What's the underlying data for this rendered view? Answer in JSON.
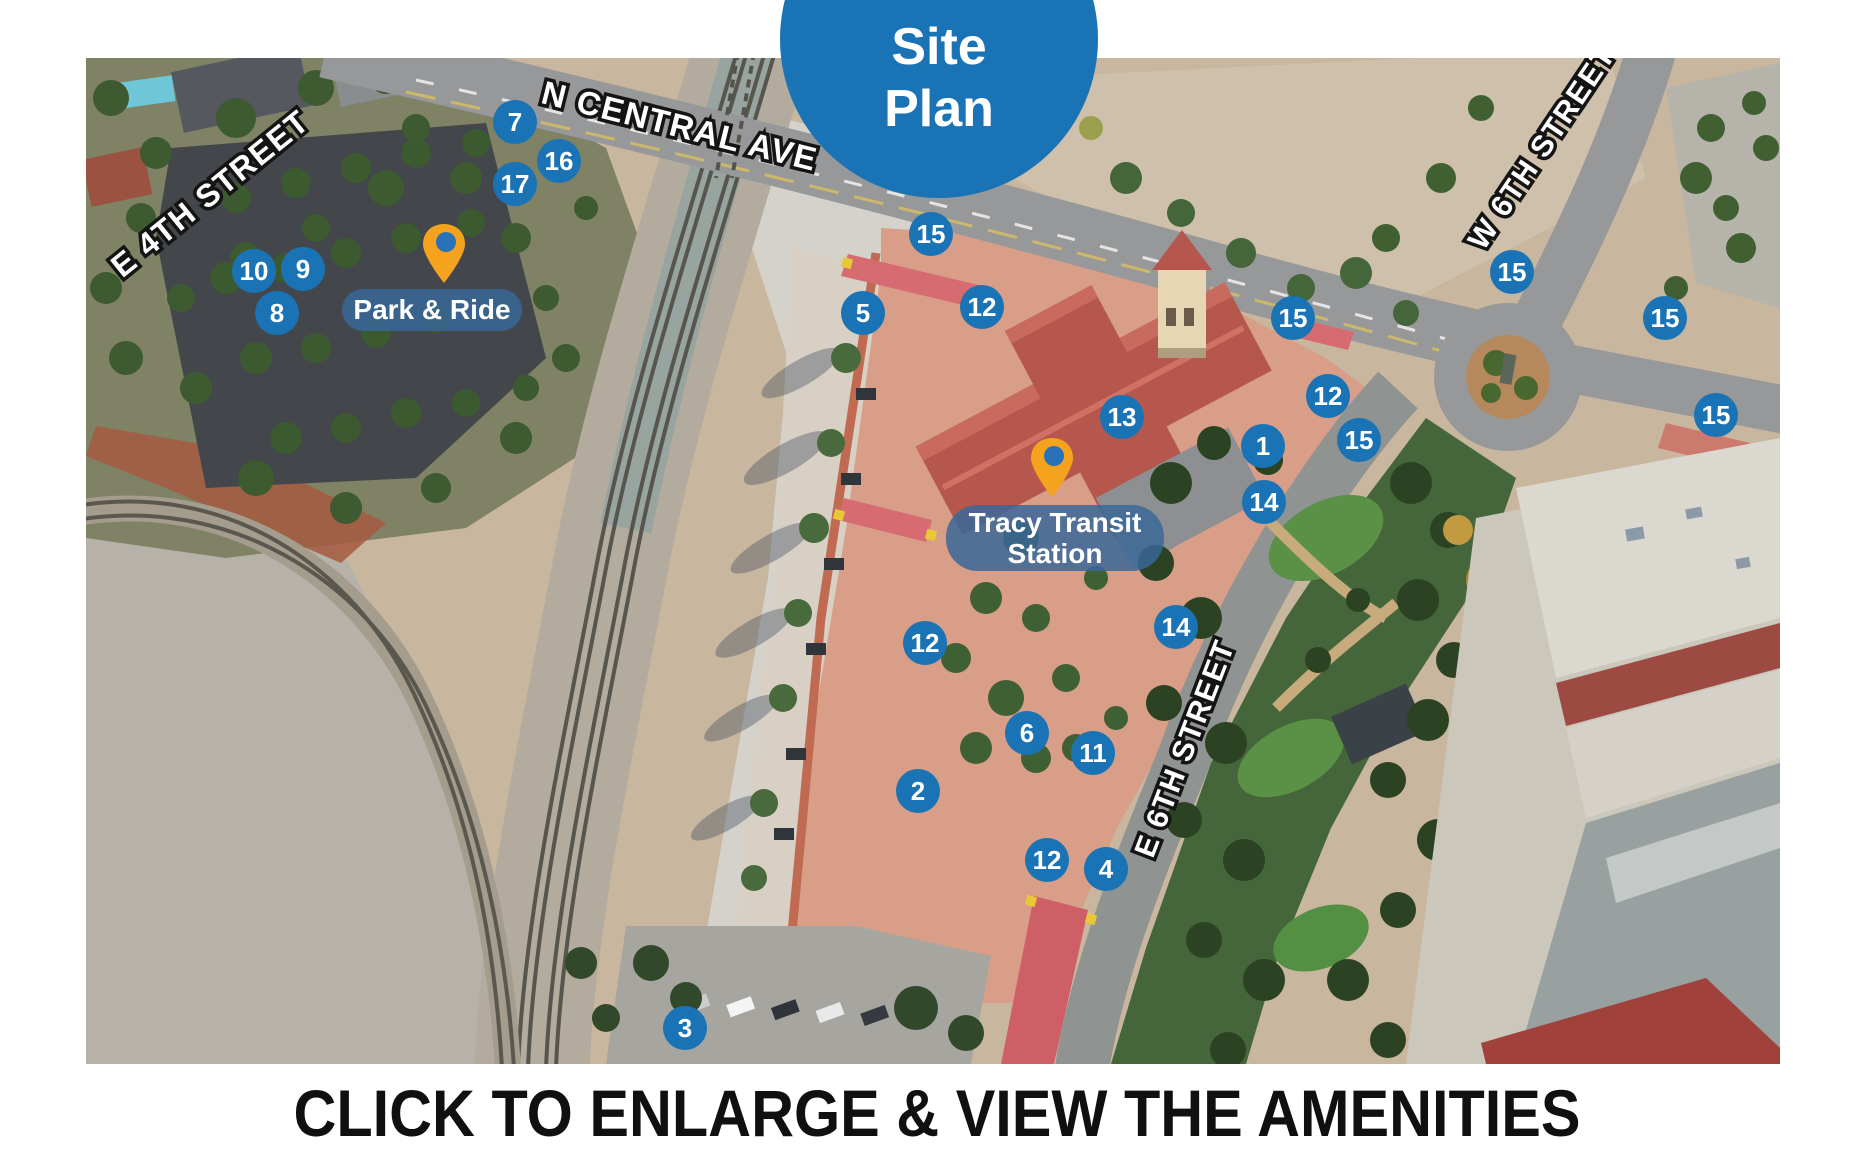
{
  "badge": {
    "line1": "Site",
    "line2": "Plan"
  },
  "caption": "CLICK TO ENLARGE & VIEW THE AMENITIES",
  "map": {
    "colors": {
      "marker_blue": "#1a73b5",
      "badge_blue": "#1a73b5",
      "pin_orange": "#f5a31f",
      "pin_hole": "#2a72b8",
      "label_bg": "rgba(56,104,152,0.84)"
    },
    "streets": [
      {
        "name": "E 4TH STREET"
      },
      {
        "name": "N CENTRAL AVE"
      },
      {
        "name": "W 6TH STREET"
      },
      {
        "name": "E 6TH STREET"
      }
    ],
    "pins": [
      {
        "id": "park-and-ride",
        "label": "Park & Ride"
      },
      {
        "id": "tracy-transit",
        "label_line1": "Tracy Transit",
        "label_line2": "Station"
      }
    ],
    "markers": [
      {
        "label": "7",
        "x": 429,
        "y": 64
      },
      {
        "label": "16",
        "x": 473,
        "y": 103
      },
      {
        "label": "17",
        "x": 429,
        "y": 126
      },
      {
        "label": "10",
        "x": 168,
        "y": 213
      },
      {
        "label": "9",
        "x": 217,
        "y": 211
      },
      {
        "label": "8",
        "x": 191,
        "y": 255
      },
      {
        "label": "15",
        "x": 845,
        "y": 176
      },
      {
        "label": "5",
        "x": 777,
        "y": 255
      },
      {
        "label": "12",
        "x": 896,
        "y": 249
      },
      {
        "label": "13",
        "x": 1036,
        "y": 359
      },
      {
        "label": "15",
        "x": 1207,
        "y": 260
      },
      {
        "label": "12",
        "x": 1242,
        "y": 338
      },
      {
        "label": "1",
        "x": 1177,
        "y": 388
      },
      {
        "label": "15",
        "x": 1273,
        "y": 382
      },
      {
        "label": "14",
        "x": 1178,
        "y": 444
      },
      {
        "label": "15",
        "x": 1426,
        "y": 214
      },
      {
        "label": "15",
        "x": 1579,
        "y": 260
      },
      {
        "label": "15",
        "x": 1630,
        "y": 357
      },
      {
        "label": "12",
        "x": 839,
        "y": 585
      },
      {
        "label": "14",
        "x": 1090,
        "y": 569
      },
      {
        "label": "6",
        "x": 941,
        "y": 675
      },
      {
        "label": "11",
        "x": 1007,
        "y": 695
      },
      {
        "label": "2",
        "x": 832,
        "y": 733
      },
      {
        "label": "12",
        "x": 961,
        "y": 802
      },
      {
        "label": "4",
        "x": 1020,
        "y": 811
      },
      {
        "label": "3",
        "x": 599,
        "y": 970
      }
    ]
  }
}
